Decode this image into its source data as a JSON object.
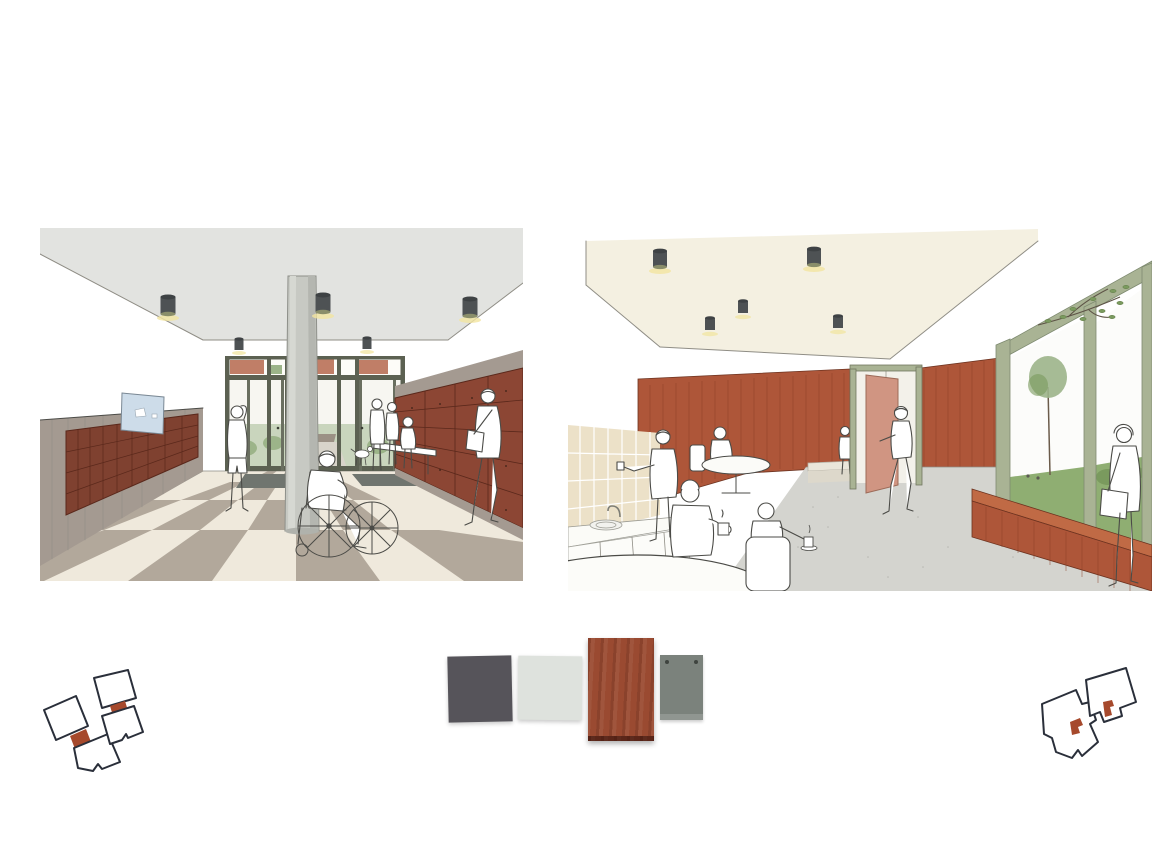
{
  "page": {
    "background": "#ffffff"
  },
  "palette": {
    "paper": "#ffffff",
    "sketch-line": "#4b4b47",
    "ceiling-grey": "#e2e3e0",
    "ceiling-cream": "#f4f0e1",
    "wainscot-taupe": "#a49a91",
    "mailbox-red": "#7f4130",
    "locker-red": "#8c4634",
    "wood-red": "#ae5639",
    "wood-grain": "#8a4028",
    "noticeboard-blue": "#cddce9",
    "frame-olive": "#5c6152",
    "sage-green": "#a9b394",
    "floor-cream": "#efe9dc",
    "tile-taupe": "#b2a89b",
    "floor-grey": "#d4d4cf",
    "tile-tan": "#ece1c8",
    "park-green": "#9cb489",
    "grass-green": "#8fae72",
    "shrub-green": "#7a9a5e",
    "light-grey-fixture": "#4e5254",
    "glow-yellow": "#f2e5a0",
    "brick-red": "#b5674e",
    "mat-grey": "#70756f",
    "column-grey": "#c7c9c3",
    "door-leaf-red": "#d09582",
    "keyplan-red": "#a6492c",
    "keyplan-line": "#2a2f3a"
  },
  "panels": {
    "left": {
      "id": "entrance-lobby-perspective",
      "ceiling_lights_front": 3,
      "ceiling_lights_back": 2,
      "mailbox_rows": 4,
      "locker_rows": 5,
      "figures": 7
    },
    "right": {
      "id": "communal-kitchen-perspective",
      "ceiling_lights_large": 2,
      "ceiling_lights_small": 3,
      "figures": 8
    }
  },
  "swatches": [
    {
      "id": "anthracite-tile",
      "color": "#56545a"
    },
    {
      "id": "pale-grey-tile",
      "color": "#dee2dd"
    },
    {
      "id": "mahogany-veneer-panel",
      "color": "#9a4a31"
    },
    {
      "id": "grey-green-panel",
      "color": "#7b827c"
    }
  ],
  "keyplans": {
    "left": {
      "plans": 2,
      "highlight": "link-connector"
    },
    "right": {
      "plans": 2,
      "highlight": "interior-room-marker"
    }
  }
}
